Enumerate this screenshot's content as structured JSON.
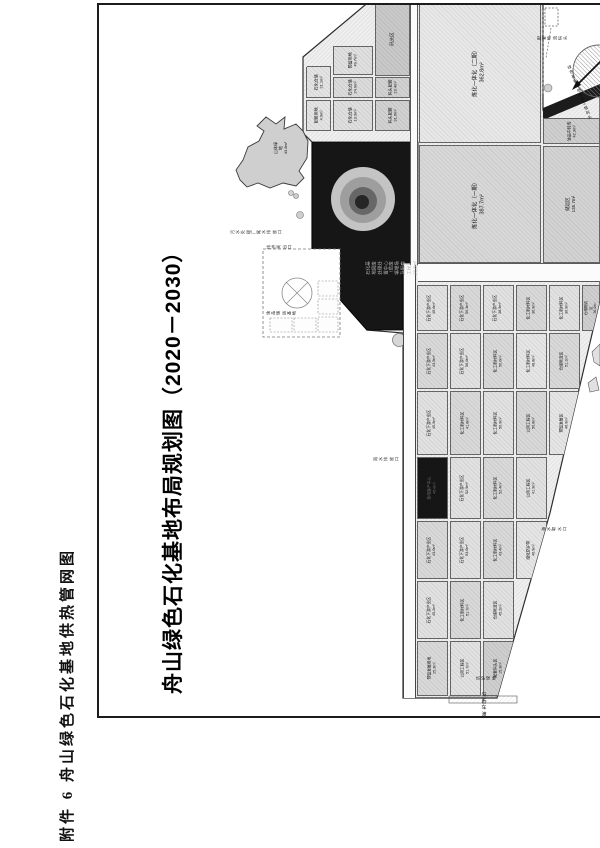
{
  "page": {
    "attachment_caption": "附件 6 舟山绿色石化基地供热管网图",
    "title": "舟山绿色石化基地布局规划图（2020－2030）"
  },
  "map": {
    "accent_colors": {
      "land": "#efefef",
      "dark_parcel": "#161616",
      "frame": "#1c1c1c"
    },
    "parcels": [
      {
        "n": "炼化一体化（二期）",
        "a": "362.8m²",
        "x": 419,
        "y": 2,
        "w": 122,
        "h": 141,
        "f": "#e8e8e8",
        "fs": 5.5
      },
      {
        "n": "炼化一体化（一期）",
        "a": "387.7m²",
        "x": 419,
        "y": 145,
        "w": 122,
        "h": 118,
        "f": "#d8d8d8",
        "fs": 5.5
      },
      {
        "n": "油品中转库",
        "a": "42.3m²",
        "x": 543,
        "y": 118,
        "w": 57,
        "h": 26,
        "f": "#cfcfcf",
        "fs": 4
      },
      {
        "n": "储运区",
        "a": "135.7m²",
        "x": 543,
        "y": 146,
        "w": 57,
        "h": 117,
        "f": "#d3d3d3",
        "fs": 4.5
      }
    ],
    "cluster": {
      "x": 303,
      "y": 3,
      "w": 112,
      "h": 129,
      "clip": "polygon(0 67px,74px 0,112px 0,112px 129px,0 129px)",
      "cells": [
        {
          "n": "码头区",
          "a": "",
          "x": 375,
          "y": 3,
          "w": 35,
          "h": 73,
          "f": "#c9c9c9",
          "fs": 4.5
        },
        {
          "n": "预留用地",
          "a": "49.7m²",
          "x": 333,
          "y": 46,
          "w": 40,
          "h": 29,
          "f": "#e0e0e0",
          "fs": 4
        },
        {
          "n": "石化仓储",
          "a": "21.1m²",
          "x": 306,
          "y": 66,
          "w": 25,
          "h": 32,
          "f": "#e4e4e4",
          "fs": 4
        },
        {
          "n": "石化仓储",
          "a": "24.9m²",
          "x": 333,
          "y": 77,
          "w": 40,
          "h": 21,
          "f": "#dcdcdc",
          "fs": 4
        },
        {
          "n": "码头配套",
          "a": "23.4m²",
          "x": 375,
          "y": 77,
          "w": 35,
          "h": 21,
          "f": "#d2d2d2",
          "fs": 4
        },
        {
          "n": "配套用地",
          "a": "4.9m²",
          "x": 306,
          "y": 100,
          "w": 25,
          "h": 31,
          "f": "#e4e4e4",
          "fs": 4
        },
        {
          "n": "石化仓储",
          "a": "13.3m²",
          "x": 333,
          "y": 100,
          "w": 40,
          "h": 31,
          "f": "#dfdfdf",
          "fs": 4
        },
        {
          "n": "码头配套",
          "a": "31.6m²",
          "x": 375,
          "y": 100,
          "w": 35,
          "h": 31,
          "f": "#d2d2d2",
          "fs": 4
        }
      ]
    },
    "grid": {
      "x": 417,
      "y": 263,
      "w": 183,
      "h": 435,
      "clip": "polygon(0 0,183px 0,183px 37px,133px 250px,80px 435px,0 435px)",
      "cells": [
        {
          "n": "石化下游产业区",
          "a": "45.6m²",
          "x": 417,
          "y": 285,
          "w": 31,
          "h": 46,
          "f": "#e2e2e2",
          "fs": 3.8
        },
        {
          "n": "石化下游产业区",
          "a": "50.3m²",
          "x": 450,
          "y": 285,
          "w": 31,
          "h": 46,
          "f": "#d9d9d9",
          "fs": 3.8
        },
        {
          "n": "石化下游产业区",
          "a": "38.9m²",
          "x": 483,
          "y": 285,
          "w": 31,
          "h": 46,
          "f": "#e2e2e2",
          "fs": 3.8
        },
        {
          "n": "化工新材料区",
          "a": "36.9m²",
          "x": 516,
          "y": 285,
          "w": 31,
          "h": 46,
          "f": "#d9d9d9",
          "fs": 3.8
        },
        {
          "n": "化工新材料区",
          "a": "30.9m²",
          "x": 549,
          "y": 285,
          "w": 31,
          "h": 46,
          "f": "#e2e2e2",
          "fs": 3.8
        },
        {
          "n": "仓储物流区",
          "a": "36.0m²",
          "x": 582,
          "y": 285,
          "w": 18,
          "h": 46,
          "f": "#cfcfcf",
          "fs": 3.5
        },
        {
          "n": "石化下游产业区",
          "a": "43.5m²",
          "x": 417,
          "y": 333,
          "w": 31,
          "h": 56,
          "f": "#d9d9d9",
          "fs": 3.8
        },
        {
          "n": "石化下游产业区",
          "a": "56.0m²",
          "x": 450,
          "y": 333,
          "w": 31,
          "h": 56,
          "f": "#e2e2e2",
          "fs": 3.8
        },
        {
          "n": "化工新材料区",
          "a": "50.0m²",
          "x": 483,
          "y": 333,
          "w": 31,
          "h": 56,
          "f": "#d9d9d9",
          "fs": 3.8
        },
        {
          "n": "化工新材料区",
          "a": "48.8m²",
          "x": 516,
          "y": 333,
          "w": 31,
          "h": 56,
          "f": "#e6e6e6",
          "fs": 3.8
        },
        {
          "n": "仓储物流区",
          "a": "51.1m²",
          "x": 549,
          "y": 333,
          "w": 31,
          "h": 56,
          "f": "#d9d9d9",
          "fs": 3.8
        },
        {
          "n": "石化下游产业区",
          "a": "45.9m²",
          "x": 417,
          "y": 391,
          "w": 31,
          "h": 64,
          "f": "#e2e2e2",
          "fs": 3.8
        },
        {
          "n": "化工新材料区",
          "a": "41.8m²",
          "x": 450,
          "y": 391,
          "w": 31,
          "h": 64,
          "f": "#d9d9d9",
          "fs": 3.8
        },
        {
          "n": "化工新材料区",
          "a": "50.9m²",
          "x": 483,
          "y": 391,
          "w": 31,
          "h": 64,
          "f": "#e2e2e2",
          "fs": 3.8
        },
        {
          "n": "公用工程区",
          "a": "50.8m²",
          "x": 516,
          "y": 391,
          "w": 31,
          "h": 64,
          "f": "#d9d9d9",
          "fs": 3.8
        },
        {
          "n": "预留发展区",
          "a": "46.9m²",
          "x": 549,
          "y": 391,
          "w": 31,
          "h": 64,
          "f": "#e6e6e6",
          "fs": 3.8
        },
        {
          "n": "热电联产中心",
          "a": "45.0m²",
          "x": 417,
          "y": 457,
          "w": 31,
          "h": 62,
          "f": "#161616",
          "lc": "#6f6f6f",
          "fs": 3.8
        },
        {
          "n": "石化下游产业区",
          "a": "52.9m²",
          "x": 450,
          "y": 457,
          "w": 31,
          "h": 62,
          "f": "#e2e2e2",
          "fs": 3.8
        },
        {
          "n": "化工新材料区",
          "a": "52.4m²",
          "x": 483,
          "y": 457,
          "w": 31,
          "h": 62,
          "f": "#d9d9d9",
          "fs": 3.8
        },
        {
          "n": "公用工程区",
          "a": "41.9m²",
          "x": 516,
          "y": 457,
          "w": 31,
          "h": 62,
          "f": "#e2e2e2",
          "fs": 3.8
        },
        {
          "n": "石化下游产业区",
          "a": "43.0m²",
          "x": 417,
          "y": 521,
          "w": 31,
          "h": 58,
          "f": "#d9d9d9",
          "fs": 3.8
        },
        {
          "n": "石化下游产业区",
          "a": "53.0m²",
          "x": 450,
          "y": 521,
          "w": 31,
          "h": 58,
          "f": "#e2e2e2",
          "fs": 3.8
        },
        {
          "n": "化工新材料区",
          "a": "43.4m²",
          "x": 483,
          "y": 521,
          "w": 31,
          "h": 58,
          "f": "#d9d9d9",
          "fs": 3.8
        },
        {
          "n": "绿化防护带",
          "a": "46.9m²",
          "x": 516,
          "y": 521,
          "w": 31,
          "h": 58,
          "f": "#e6e6e6",
          "fs": 3.8
        },
        {
          "n": "石化下游产业区",
          "a": "45.2m²",
          "x": 417,
          "y": 581,
          "w": 31,
          "h": 58,
          "f": "#e2e2e2",
          "fs": 3.8
        },
        {
          "n": "化工新材料区",
          "a": "51.7m²",
          "x": 450,
          "y": 581,
          "w": 31,
          "h": 58,
          "f": "#d9d9d9",
          "fs": 3.8
        },
        {
          "n": "仓储物流区",
          "a": "45.2m²",
          "x": 483,
          "y": 581,
          "w": 31,
          "h": 58,
          "f": "#e2e2e2",
          "fs": 3.8
        },
        {
          "n": "预留发展用地",
          "a": "25.3m²",
          "x": 417,
          "y": 641,
          "w": 31,
          "h": 55,
          "f": "#d9d9d9",
          "fs": 3.8
        },
        {
          "n": "公用工程区",
          "a": "51.7m²",
          "x": 450,
          "y": 641,
          "w": 31,
          "h": 55,
          "f": "#e2e2e2",
          "fs": 3.8
        },
        {
          "n": "配套码头区",
          "a": "15.3m²",
          "x": 483,
          "y": 641,
          "w": 31,
          "h": 55,
          "f": "#cfcfcf",
          "fs": 3.8
        }
      ]
    },
    "annotations": [
      {
        "lines": [
          "山体绿地",
          "43.8m²"
        ],
        "x": 281,
        "y": 148,
        "rot": -90,
        "fs": 4,
        "c": "#111"
      },
      {
        "lines": [
          "石化基地固废处理处置中心",
          "（危废填埋场及配套工程）",
          "23.6m²"
        ],
        "x": 392,
        "y": 268,
        "rot": -90,
        "fs": 4.5,
        "c": "#b3b3b3"
      },
      {
        "lines": [
          "污水处理厂尾水排放口"
        ],
        "x": 256,
        "y": 232,
        "rot": -90,
        "fs": 4,
        "c": "#222"
      },
      {
        "lines": [
          "排洪闸出口"
        ],
        "x": 279,
        "y": 247,
        "rot": -90,
        "fs": 4,
        "c": "#222"
      },
      {
        "lines": [
          "雨水排放口"
        ],
        "x": 386,
        "y": 459,
        "rot": -90,
        "fs": 4,
        "c": "#222"
      },
      {
        "lines": [
          "海水取水口"
        ],
        "x": 554,
        "y": 529,
        "rot": -90,
        "fs": 4,
        "c": "#222"
      },
      {
        "lines": [
          "马岙车渡口"
        ],
        "x": 484,
        "y": 708,
        "rot": 0,
        "fs": 5,
        "c": "#111"
      },
      {
        "lines": [
          "配套物流码头"
        ],
        "x": 552,
        "y": 38,
        "rot": -90,
        "fs": 4,
        "c": "#222"
      },
      {
        "lines": [
          "绿色石化基地配套工程码头"
        ],
        "x": 580,
        "y": 93,
        "rot": -22,
        "fs": 3.8,
        "c": "#111"
      },
      {
        "lines": [
          "油品储运基地"
        ],
        "x": 281,
        "y": 313,
        "rot": -90,
        "fs": 4,
        "c": "#222"
      },
      {
        "lines": [
          "防护绿地"
        ],
        "x": 486,
        "y": 678,
        "rot": -90,
        "fs": 4,
        "c": "#222"
      }
    ]
  }
}
